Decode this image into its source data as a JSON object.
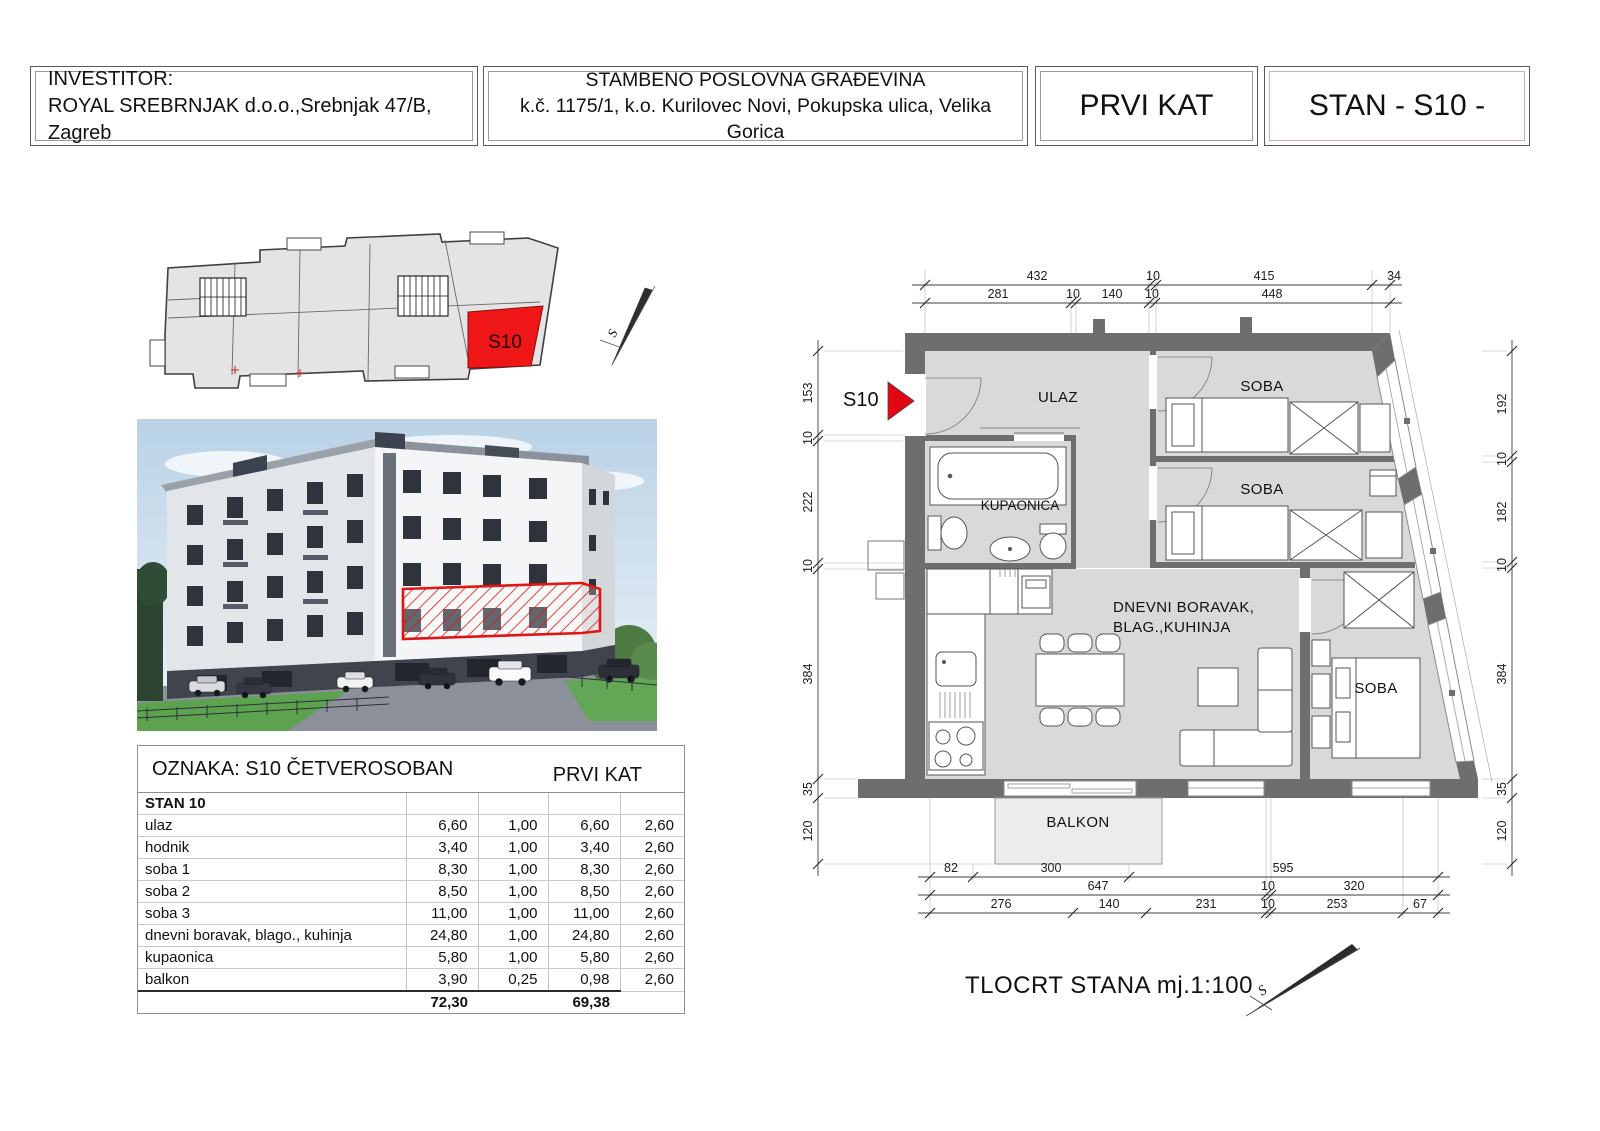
{
  "header": {
    "investor_label": "INVESTITOR:",
    "investor": "ROYAL SREBRNJAK d.o.o.,Srebnjak 47/B, Zagreb",
    "project_line1": "STAMBENO POSLOVNA GRAĐEVINA",
    "project_line2": "k.č. 1175/1, k.o. Kurilovec Novi, Pokupska ulica, Velika Gorica",
    "floor": "PRVI KAT",
    "unit": "STAN - S10 -"
  },
  "keyplan": {
    "unit_label": "S10",
    "north_label": "S"
  },
  "area_table": {
    "title_left": "OZNAKA: S10  ČETVEROSOBAN",
    "title_right": "PRVI KAT",
    "group": "STAN 10",
    "rows": [
      {
        "name": "ulaz",
        "a": "6,60",
        "k": "1,00",
        "p": "6,60",
        "h": "2,60"
      },
      {
        "name": "hodnik",
        "a": "3,40",
        "k": "1,00",
        "p": "3,40",
        "h": "2,60"
      },
      {
        "name": "soba 1",
        "a": "8,30",
        "k": "1,00",
        "p": "8,30",
        "h": "2,60"
      },
      {
        "name": "soba 2",
        "a": "8,50",
        "k": "1,00",
        "p": "8,50",
        "h": "2,60"
      },
      {
        "name": "soba 3",
        "a": "11,00",
        "k": "1,00",
        "p": "11,00",
        "h": "2,60"
      },
      {
        "name": "dnevni boravak, blago., kuhinja",
        "a": "24,80",
        "k": "1,00",
        "p": "24,80",
        "h": "2,60"
      },
      {
        "name": "kupaonica",
        "a": "5,80",
        "k": "1,00",
        "p": "5,80",
        "h": "2,60"
      },
      {
        "name": "balkon",
        "a": "3,90",
        "k": "0,25",
        "p": "0,98",
        "h": "2,60"
      }
    ],
    "total_a": "72,30",
    "total_p": "69,38"
  },
  "plan": {
    "entrance_marker": "S10",
    "rooms": {
      "ulaz": "ULAZ",
      "soba_top": "SOBA",
      "soba_mid": "SOBA",
      "kupaonica": "KUPAONICA",
      "living_line1": "DNEVNI BORAVAK,",
      "living_line2": "BLAG.,KUHINJA",
      "soba_bottom": "SOBA",
      "balkon": "BALKON"
    },
    "dims": {
      "top_row1": [
        "432",
        "10",
        "415",
        "34"
      ],
      "top_row2": [
        "281",
        "10",
        "140",
        "10",
        "448"
      ],
      "left": [
        "153",
        "10",
        "222",
        "10",
        "384",
        "35",
        "120"
      ],
      "right": [
        "192",
        "10",
        "182",
        "10",
        "384",
        "35",
        "120"
      ],
      "bottom_row1": [
        "82",
        "300",
        "595"
      ],
      "bottom_row2": [
        "647",
        "10",
        "320"
      ],
      "bottom_row3": [
        "276",
        "140",
        "231",
        "10",
        "253",
        "67"
      ]
    },
    "north_label": "S",
    "scale_note": "TLOCRT STANA mj.1:100"
  },
  "colors": {
    "accent_red": "#e30613",
    "wall_gray": "#6e6e6e",
    "room_fill": "#d9d9d9"
  }
}
